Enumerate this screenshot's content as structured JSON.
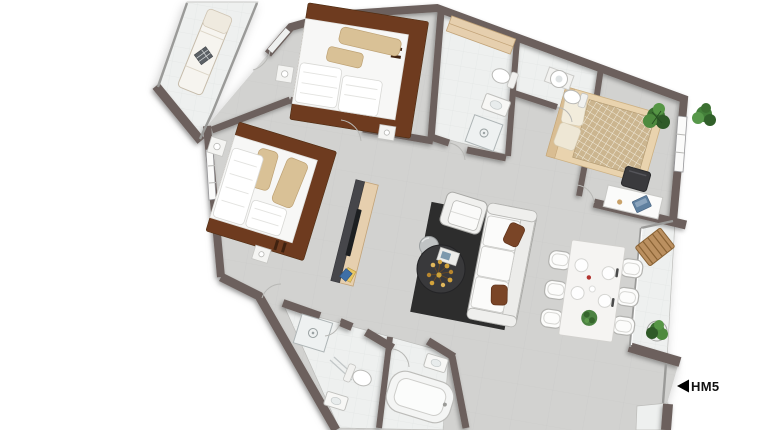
{
  "marker": {
    "label": "HM5"
  },
  "colors": {
    "wall": "#6c615d",
    "floor": "#d2d2d0",
    "floorLight": "#eef0ef",
    "glass": "#fbfbfa",
    "bedFrame": "#6e3b1f",
    "bedding": "#f7f7f6",
    "pillow": "#d9c196",
    "wood": "#e6cfae",
    "woodDark": "#c2a378",
    "bench": "#bb9060",
    "tvDark": "#46464a",
    "tv": "#1d1f21",
    "rug": "#2d2d2d",
    "tableDark": "#39393b",
    "sofa": "#f6f6f5",
    "sofaLine": "#a8a8a5",
    "cushion": "#7a4527",
    "plant": "#3c7031",
    "plantLight": "#569645",
    "plantDark": "#2f5a28",
    "laptop": "#60809f",
    "flower": "#d4a43c",
    "fixture": "#ffffff",
    "fixtureLine": "#b9b9b6",
    "label": "#111111"
  }
}
